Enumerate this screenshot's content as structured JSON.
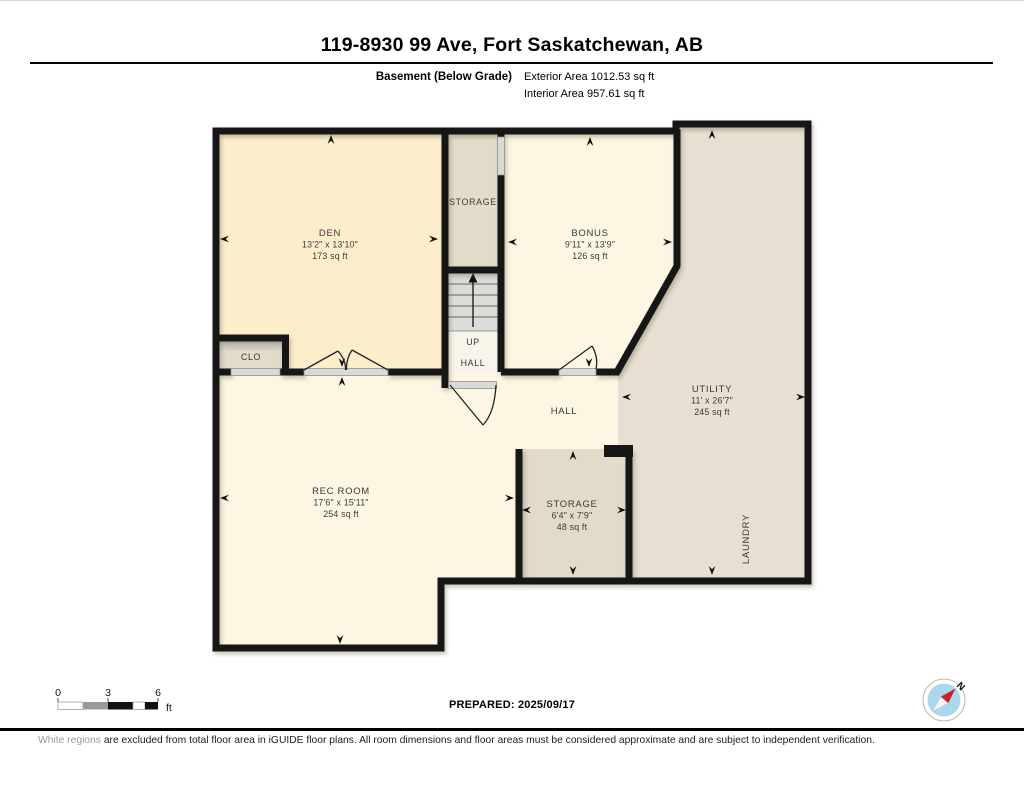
{
  "header": {
    "title": "119-8930 99 Ave, Fort Saskatchewan, AB",
    "floor_label": "Basement (Below Grade)",
    "exterior_area": "Exterior Area 1012.53 sq ft",
    "interior_area": "Interior Area 957.61 sq ft"
  },
  "plan": {
    "den": {
      "name": "DEN",
      "dims": "13'2\" x 13'10\"",
      "area": "173 sq ft"
    },
    "storage_top": {
      "name": "STORAGE"
    },
    "bonus": {
      "name": "BONUS",
      "dims": "9'11\" x 13'9\"",
      "area": "126 sq ft"
    },
    "clo": {
      "name": "CLO"
    },
    "up_hall": {
      "up": "UP",
      "hall": "HALL"
    },
    "hall": {
      "name": "HALL"
    },
    "utility": {
      "name": "UTILITY",
      "dims": "11' x 26'7\"",
      "area": "245 sq ft"
    },
    "rec_room": {
      "name": "REC ROOM",
      "dims": "17'6\" x 15'11\"",
      "area": "254 sq ft"
    },
    "storage_lower": {
      "name": "STORAGE",
      "dims": "6'4\" x 7'9\"",
      "area": "48 sq ft"
    },
    "laundry": {
      "name": "LAUNDRY"
    }
  },
  "footer": {
    "scale": {
      "ticks": [
        "0",
        "3",
        "6"
      ],
      "unit": "ft"
    },
    "prepared": "PREPARED: 2025/09/17",
    "compass_label": "N",
    "disclaimer_lead": "White regions",
    "disclaimer_rest": " are excluded from total floor area in iGUIDE floor plans. All room dimensions and floor areas must be considered approximate and are subject to independent verification."
  },
  "colors": {
    "wall": "#161616",
    "den_fill": "#fdeecb",
    "cream_fill": "#fdf6e2",
    "beige_fill": "#e2dbca",
    "utility_fill": "#e7e0d2",
    "stair_fill": "#dcdcd8",
    "uphall_fill": "#f8f4e9",
    "door_fill": "#d9d9d6",
    "compass_blue": "#a9d8ef",
    "needle_red": "#cc2127"
  }
}
